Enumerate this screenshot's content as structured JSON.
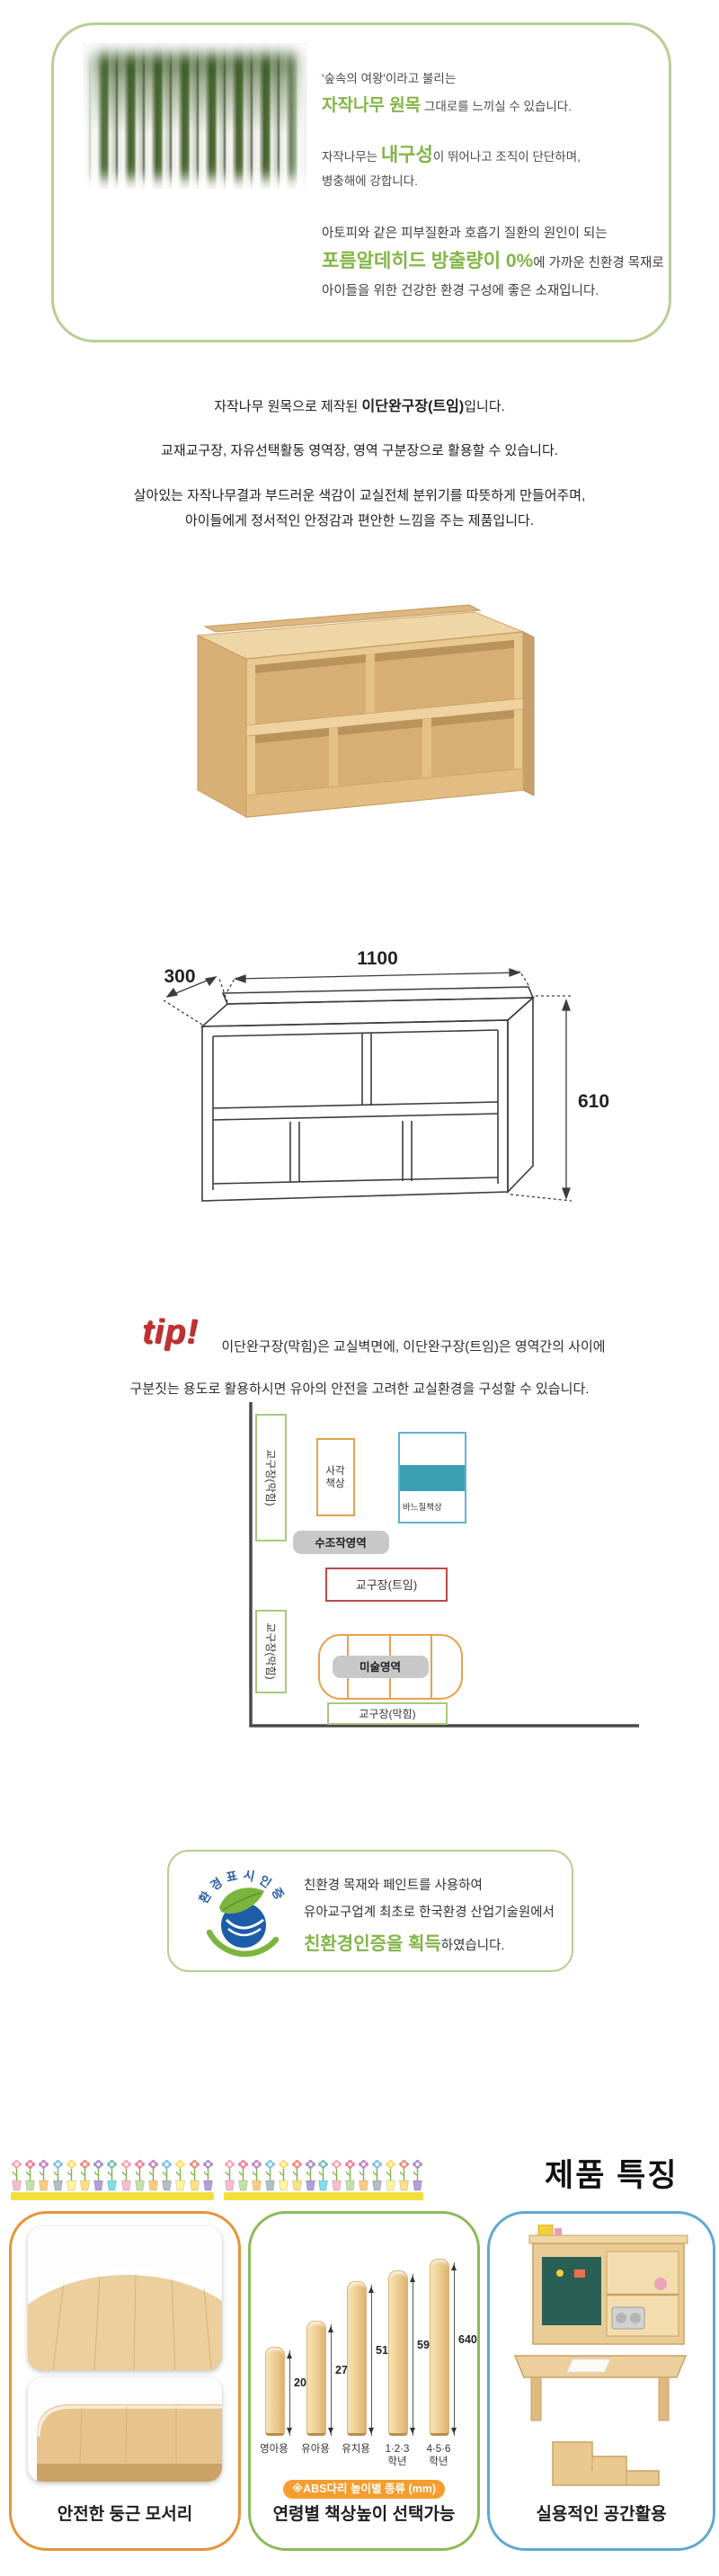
{
  "intro": {
    "line1": "'숲속의 여왕'이라고 불리는",
    "line2_green": "자작나무 원목",
    "line2_rest": " 그대로를 느끼실 수 있습니다.",
    "line3_pre": "자작나무는 ",
    "line3_green": "내구성",
    "line3_rest": "이 뛰어나고 조직이 단단하며,",
    "line4": "병충해에 강합니다.",
    "line5": "아토피와 같은 피부질환과 호흡기 질환의 원인이 되는",
    "line6_green": "포름알데히드 방출량이 0%",
    "line6_rest": "에 가까운 친환경 목재로",
    "line7": "아이들을 위한 건강한 환경 구성에 좋은 소재입니다."
  },
  "description": {
    "line1_pre": "자작나무 원목으로 제작된 ",
    "line1_bold": "이단완구장(트임)",
    "line1_post": "입니다.",
    "line2": "교재교구장, 자유선택활동 영역장, 영역 구분장으로 활용할 수 있습니다.",
    "line3": "살아있는 자작나무결과 부드러운 색감이 교실전체 분위기를 따뜻하게 만들어주며,",
    "line4": "아이들에게 정서적인 안정감과 편안한 느낌을 주는 제품입니다."
  },
  "dimensions": {
    "depth": "300",
    "width": "1100",
    "height": "610"
  },
  "tip": {
    "label": "tip!",
    "line1": "이단완구장(막힘)은 교실벽면에, 이단완구장(트임)은 영역간의 사이에",
    "line2": "구분짓는 용도로 활용하시면 유아의 안전을 고려한 교실환경을 구성할 수 있습니다."
  },
  "diagram": {
    "wall_cabinet_top": "교구장(막힘)",
    "wall_cabinet_bottom": "교구장(막힘)",
    "square_desk_l1": "사각",
    "square_desk_l2": "책상",
    "sewing_desk": "바느질책상",
    "manipulative_area": "수조작영역",
    "open_cabinet": "교구장(트임)",
    "art_area": "미술영역",
    "bottom_cabinet": "교구장(막힘)"
  },
  "certification": {
    "logo_text": "환경표시인증",
    "line1": "친환경 목재와 페인트를 사용하여",
    "line2": "유아교구업계 최초로 한국환경 산업기술원에서",
    "line3_green": "친환경인증을 획득",
    "line3_rest": "하였습니다."
  },
  "features": {
    "heading": "제품 특징",
    "cards": [
      {
        "caption": "안전한 둥근 모서리"
      },
      {
        "caption": "연령별 책상높이 선택가능",
        "note": "※ABS다리 높이별 종류 (mm)",
        "legs": [
          {
            "label": "영아용",
            "value": "200"
          },
          {
            "label": "유아용",
            "value": "270"
          },
          {
            "label": "유치용",
            "value": "510"
          },
          {
            "label": "1·2·3\n학년",
            "value": "590"
          },
          {
            "label": "4·5·6\n학년",
            "value": "640"
          }
        ]
      },
      {
        "caption": "실용적인 공간활용"
      }
    ]
  },
  "colors": {
    "accent_green": "#82b546",
    "box_border_green": "#b7cf94",
    "tip_red": "#c53030",
    "card_orange": "#e8933c",
    "card_green": "#8cbb5a",
    "card_blue": "#62a8d0",
    "diagram_green": "#a9c97e",
    "diagram_orange": "#e8a04c",
    "diagram_blue": "#62b0d4",
    "diagram_red": "#b94a48",
    "diagram_teal": "#3ba0b4",
    "pill_gray": "#c8c8c8",
    "pill_orange": "#f59d2e",
    "yellow_bar": "#f2df3b",
    "logo_blue": "#1d5ca8",
    "logo_leaf_green": "#7cb53e",
    "wood_light": "#eed3a2",
    "wood_mid": "#e7c48d"
  },
  "icons": {
    "birch_image": "birch-forest-image",
    "eco_logo": "eco-certification-logo",
    "flower_border": "flower-pot-icon"
  }
}
